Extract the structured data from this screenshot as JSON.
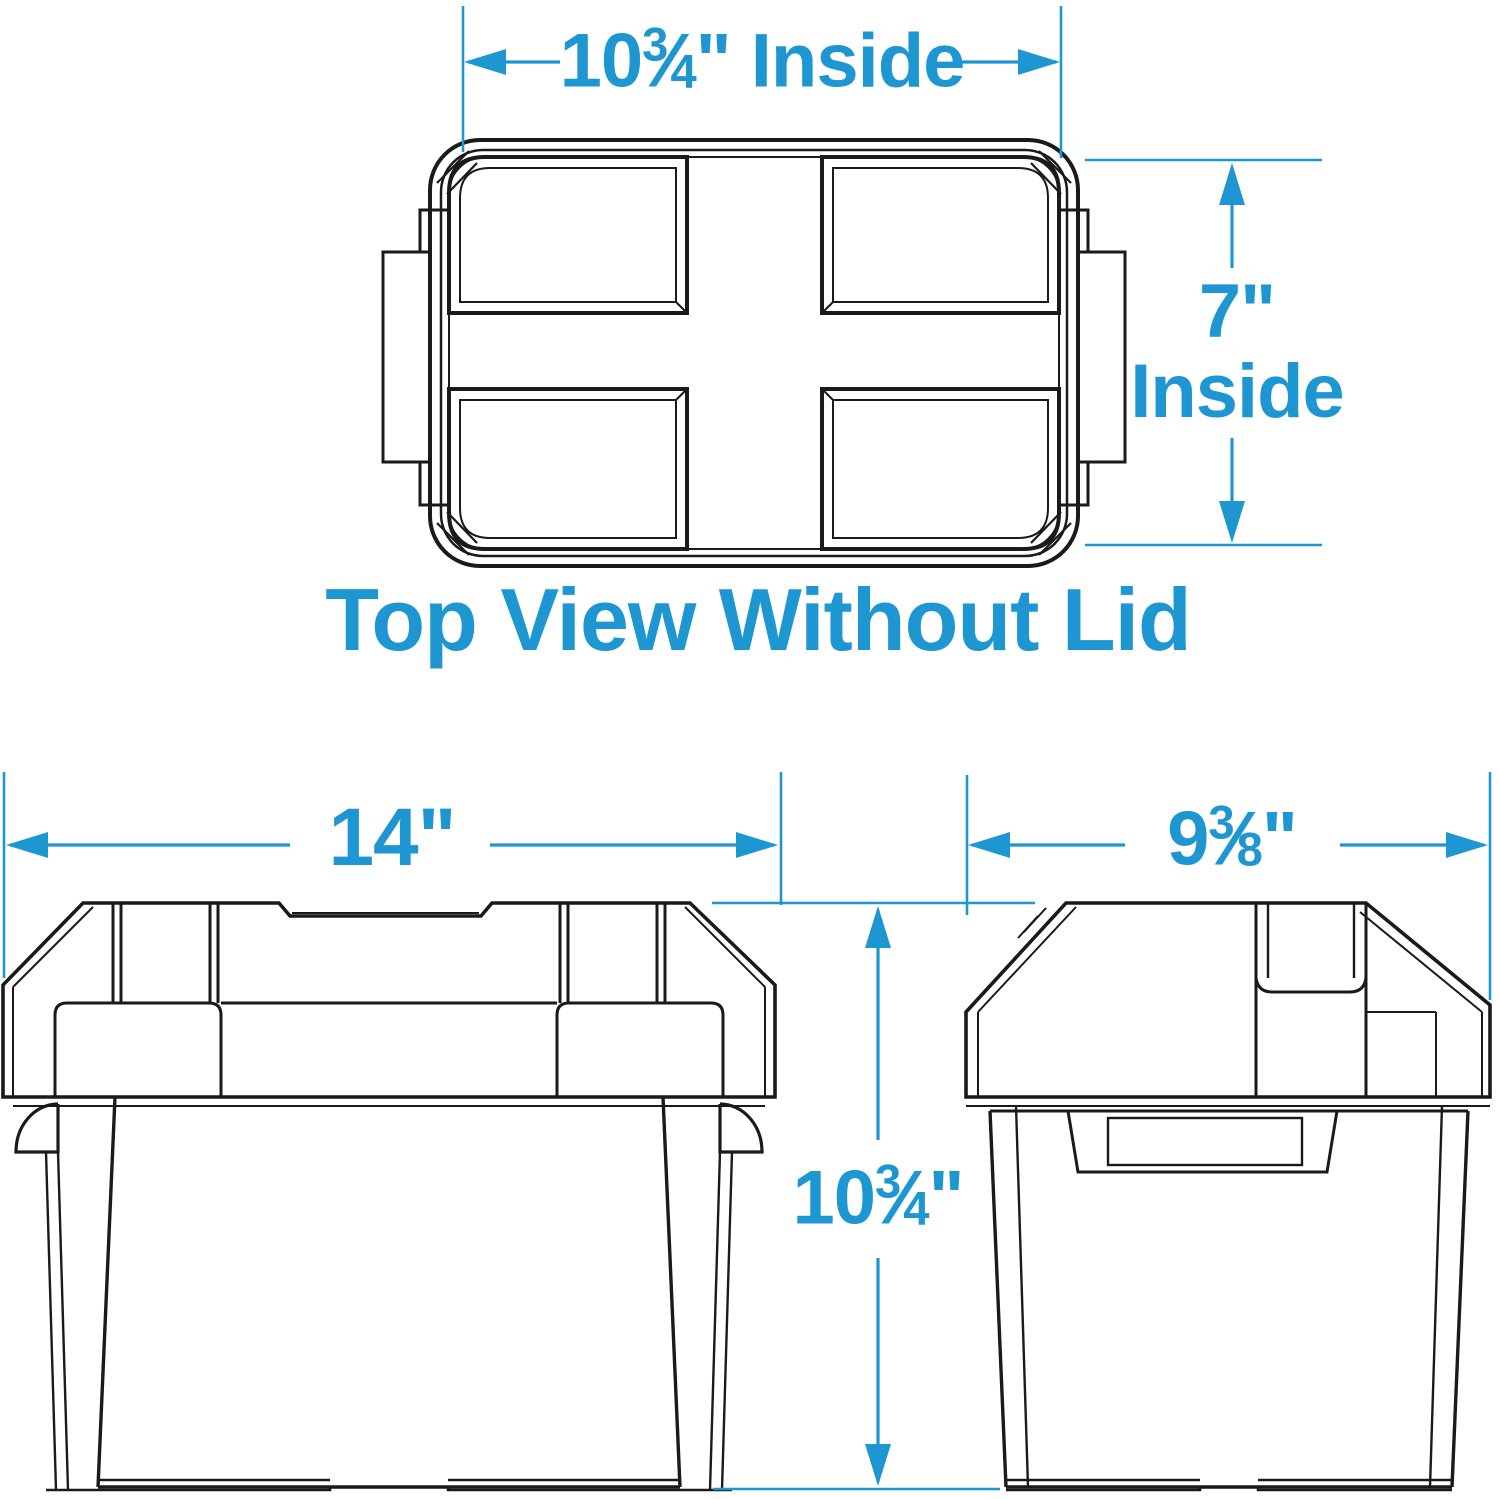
{
  "colors": {
    "accent": "#1E96D2",
    "line": "#1A1A1A",
    "background": "#FFFFFF"
  },
  "glyphs": {
    "fraction_slash": "⁄"
  },
  "labels": {
    "top_inside_width": {
      "whole": "10",
      "num": "3",
      "den": "4",
      "suffix": "\" Inside"
    },
    "inside_depth_value": "7\"",
    "inside_depth_word": "Inside",
    "caption": "Top View Without Lid",
    "front_width": "14\"",
    "side_depth": {
      "whole": "9",
      "num": "3",
      "den": "8",
      "suffix": "\""
    },
    "overall_height": {
      "whole": "10",
      "num": "3",
      "den": "4",
      "suffix": "\""
    }
  }
}
